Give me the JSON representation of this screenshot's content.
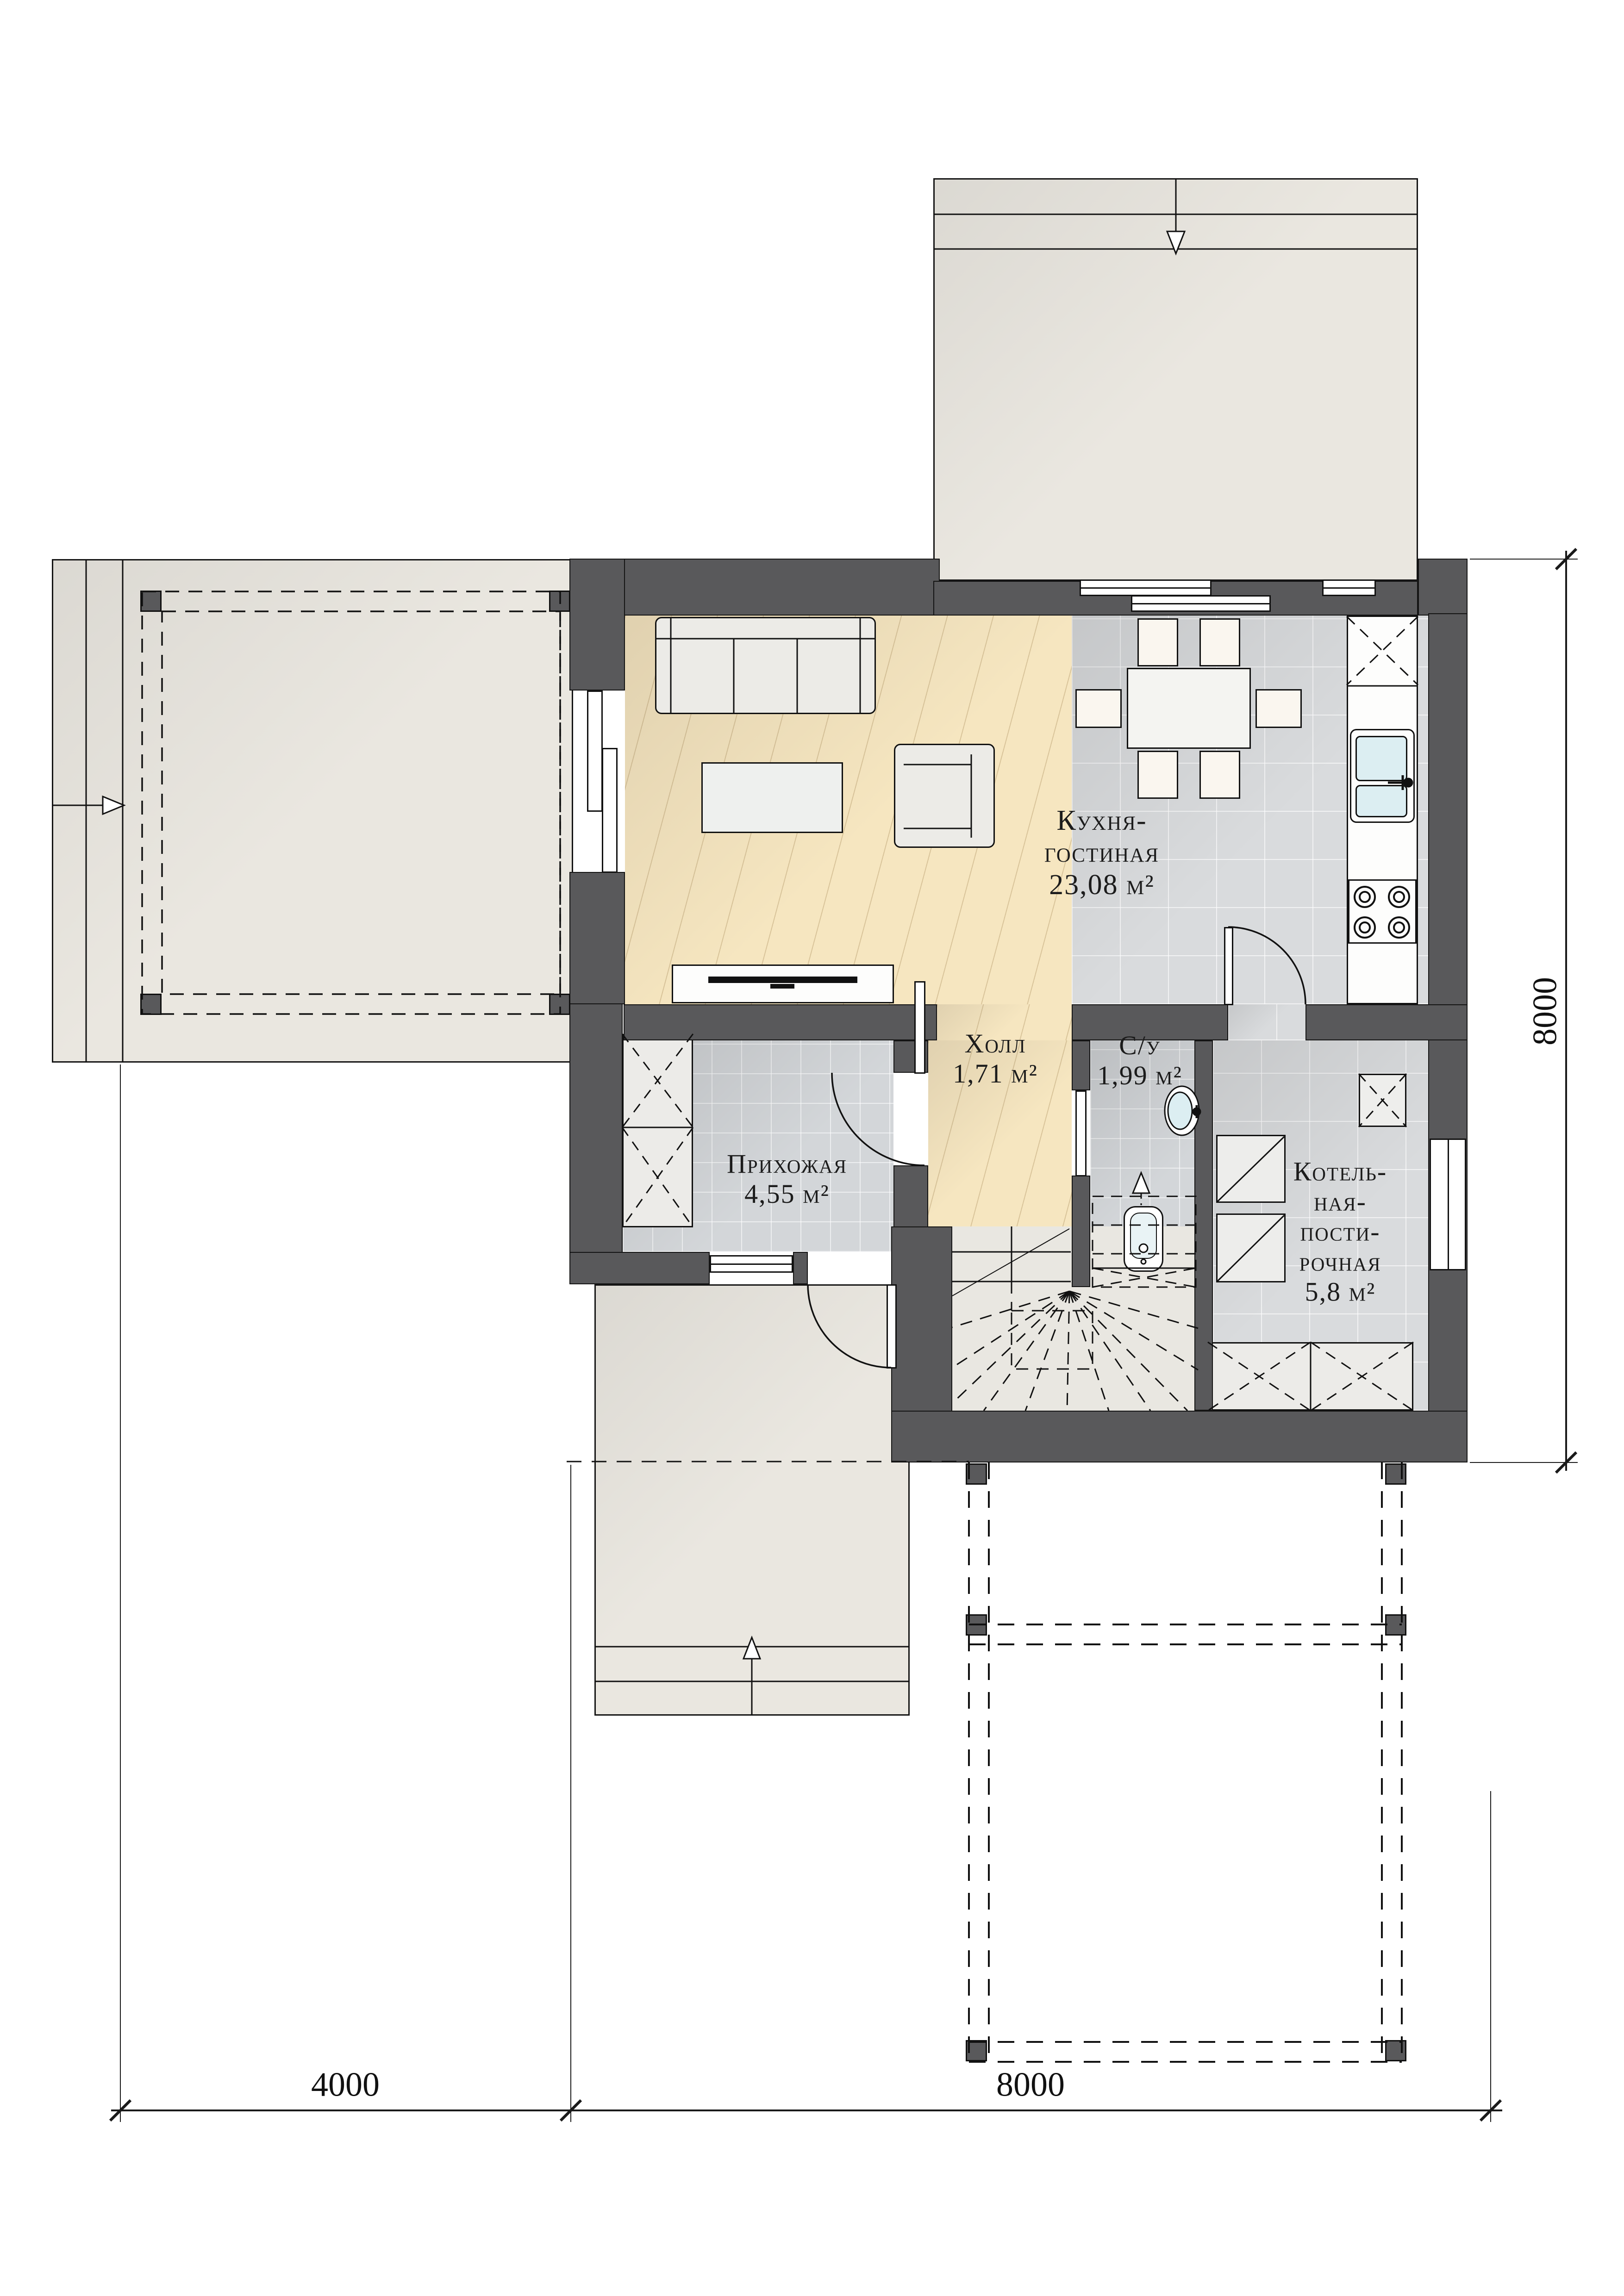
{
  "title": "Поэтажный план 1 этажа",
  "rooms": {
    "kitchen_living": {
      "lines": [
        "Кухня-",
        "гостиная",
        "23,08 м²"
      ]
    },
    "hall": {
      "lines": [
        "Холл",
        "1,71 м²"
      ]
    },
    "bathroom": {
      "lines": [
        "С/у",
        "1,99 м²"
      ]
    },
    "entry": {
      "lines": [
        "Прихожая",
        "4,55 м²"
      ]
    },
    "boiler_laundry": {
      "lines": [
        "Котель-",
        "ная-",
        "пости-",
        "рочная",
        "5,8 м²"
      ]
    }
  },
  "dimensions": {
    "bottom": [
      "4000",
      "8000"
    ],
    "right": [
      "8000"
    ]
  },
  "colors": {
    "wall": "#59595b",
    "wood_floor": "#f6e6c0",
    "tile_floor": "#d9dbdd",
    "terrace": "#eae7e0",
    "sink_water": "#dceef2"
  }
}
